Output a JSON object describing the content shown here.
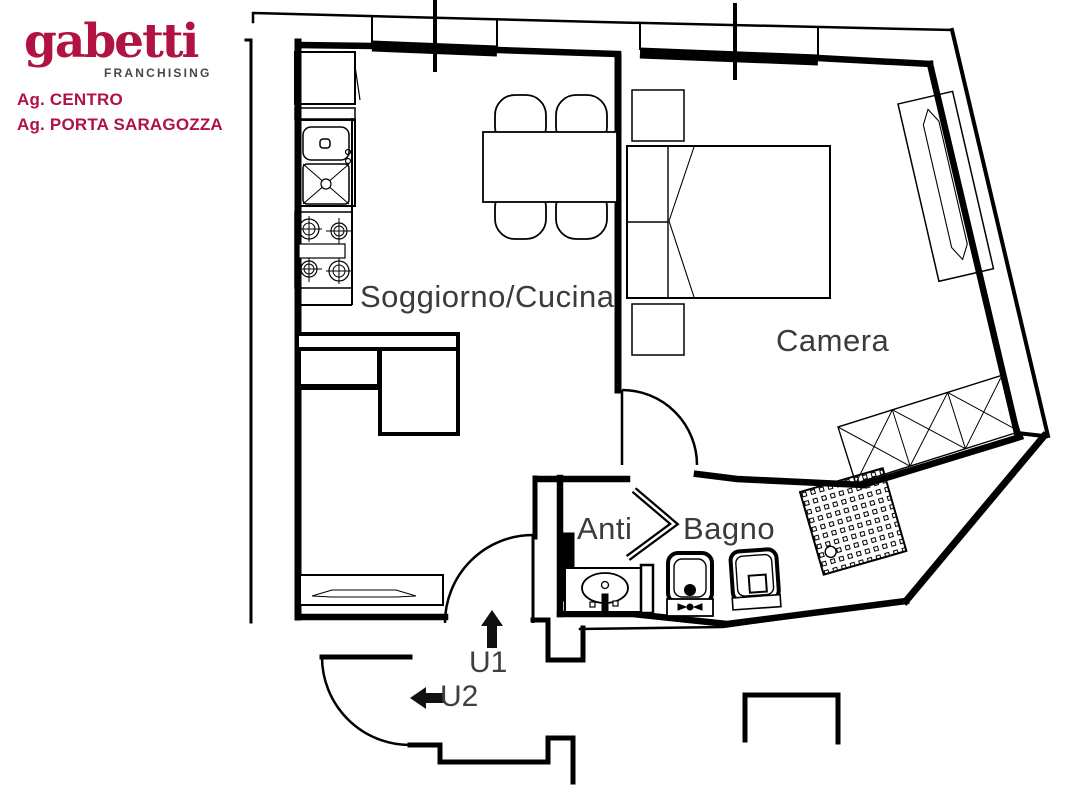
{
  "branding": {
    "brand": "gabetti",
    "sub": "FRANCHISING",
    "agency1": "Ag. CENTRO",
    "agency2": "Ag. PORTA SARAGOZZA",
    "brand_color": "#b01342",
    "sub_color": "#46464e"
  },
  "floorplan": {
    "type": "apartment-floor-plan",
    "rooms": [
      {
        "name": "Soggiorno/Cucina"
      },
      {
        "name": "Camera"
      },
      {
        "name": "Anti"
      },
      {
        "name": "Bagno"
      }
    ],
    "units": [
      {
        "label": "U1",
        "icon": "up-arrow-icon"
      },
      {
        "label": "U2",
        "icon": "left-arrow-icon"
      }
    ],
    "furniture": [
      "fridge",
      "kitchen-sink",
      "stove",
      "dining-table",
      "chairs",
      "l-shaped-sofa",
      "radiator",
      "entrance-doors",
      "double-bed",
      "nightstands",
      "wardrobe",
      "desk-radiator",
      "washbasin",
      "bidet",
      "toilet",
      "shower"
    ],
    "wall_color": "#000000",
    "label_color": "#3b3b3b"
  }
}
